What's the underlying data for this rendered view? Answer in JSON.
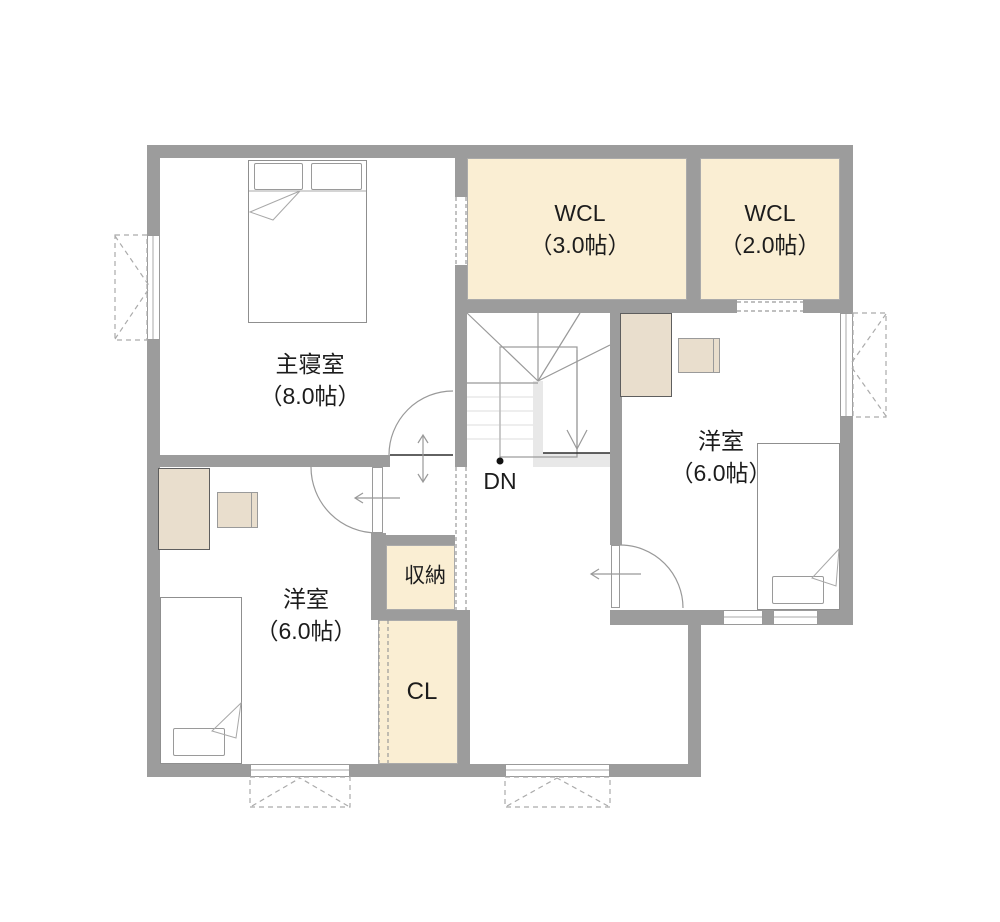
{
  "colors": {
    "wall": "#9c9c9c",
    "room_fill": "#faeed3",
    "furniture_fill": "#e9decd",
    "stair_accent": "#e8e8e8"
  },
  "rooms": {
    "master_bedroom": {
      "name": "主寝室",
      "size": "（8.0帖）"
    },
    "wcl_large": {
      "name": "WCL",
      "size": "（3.0帖）"
    },
    "wcl_small": {
      "name": "WCL",
      "size": "（2.0帖）"
    },
    "western_room_right": {
      "name": "洋室",
      "size": "（6.0帖）"
    },
    "western_room_left": {
      "name": "洋室",
      "size": "（6.0帖）"
    },
    "storage": {
      "name": "収納"
    },
    "closet": {
      "name": "CL"
    }
  },
  "stairs": {
    "direction_label": "DN"
  }
}
